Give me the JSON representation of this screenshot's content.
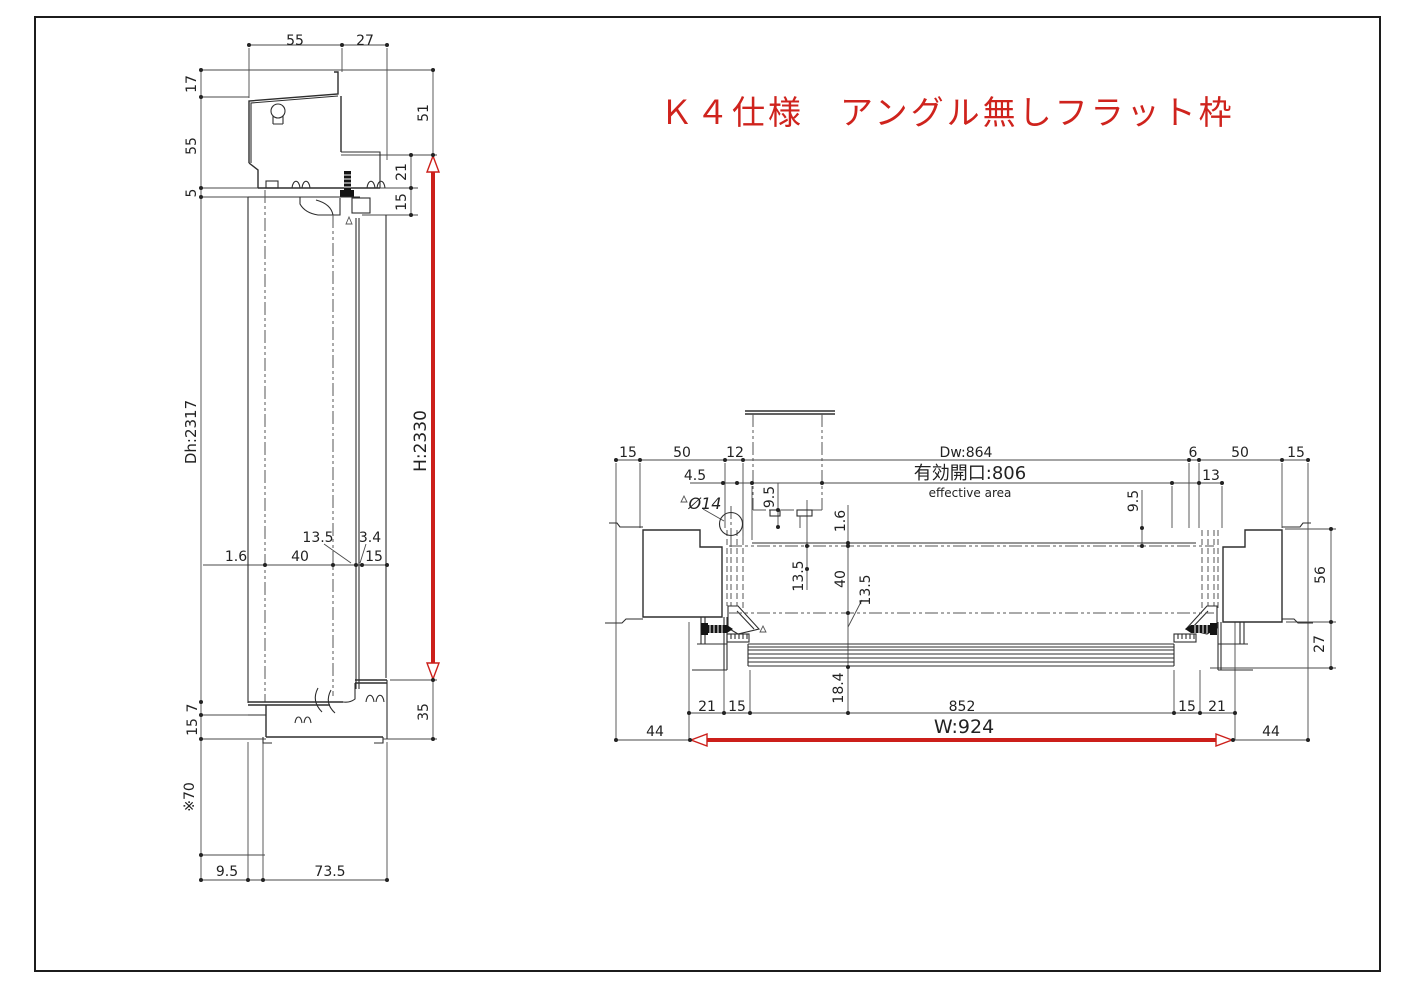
{
  "title": {
    "text": "Ｋ４仕様　アングル無しフラット枠",
    "color": "#cf231d"
  },
  "colors": {
    "line": "#2e2e2e",
    "red_dimension": "#cc1f1a",
    "background": "#ffffff"
  },
  "left_view": {
    "name": "vertical-section",
    "height_dimension": "H:2330",
    "door_height": "Dh:2317",
    "top_dims": [
      "55",
      "27"
    ],
    "left_dims": [
      "17",
      "55",
      "5",
      "Dh:2317",
      "7",
      "15",
      "※70"
    ],
    "right_dims": [
      "51",
      "21",
      "15",
      "H:2330",
      "35"
    ],
    "mid_dims": [
      "13.5",
      "3.4",
      "1.6",
      "40",
      "15"
    ],
    "bottom_dims": [
      "9.5",
      "73.5"
    ]
  },
  "right_view": {
    "name": "horizontal-section",
    "width_dimension": "W:924",
    "door_width": "Dw:864",
    "effective_opening_label": "有効開口:806",
    "effective_opening_sub": "effective area",
    "top_dims": [
      "15",
      "50",
      "12",
      "Dw:864",
      "6",
      "50",
      "15",
      "13",
      "4.5"
    ],
    "detail_dims": [
      "Ø14",
      "9.5",
      "9.5",
      "1.6",
      "13.5",
      "40",
      "13.5",
      "18.4"
    ],
    "bottom_dims": [
      "21",
      "15",
      "852",
      "15",
      "21",
      "44",
      "W:924",
      "44"
    ],
    "right_dims": [
      "56",
      "27"
    ]
  },
  "labels": [
    {
      "t": "55",
      "x": 295,
      "y": 40,
      "n": "dim-55-top"
    },
    {
      "t": "27",
      "x": 365,
      "y": 40,
      "n": "dim-27-top"
    },
    {
      "t": "17",
      "x": 191,
      "y": 84,
      "r": -90,
      "n": "dim-17"
    },
    {
      "t": "55",
      "x": 191,
      "y": 146,
      "r": -90,
      "n": "dim-55-left"
    },
    {
      "t": "5",
      "x": 191,
      "y": 193,
      "r": -90,
      "n": "dim-5"
    },
    {
      "t": "51",
      "x": 423,
      "y": 113,
      "r": -90,
      "n": "dim-51"
    },
    {
      "t": "21",
      "x": 401,
      "y": 172,
      "r": -90,
      "n": "dim-21"
    },
    {
      "t": "15",
      "x": 401,
      "y": 202,
      "r": -90,
      "n": "dim-15-head"
    },
    {
      "t": "Dh:2317",
      "x": 191,
      "y": 432,
      "r": -90,
      "s": 15,
      "n": "dim-door-height"
    },
    {
      "t": "H:2330",
      "x": 421,
      "y": 441,
      "r": -90,
      "s": 17,
      "n": "dim-frame-height"
    },
    {
      "t": "13.5",
      "x": 318,
      "y": 537,
      "n": "dim-13.5-left"
    },
    {
      "t": "3.4",
      "x": 370,
      "y": 537,
      "n": "dim-3.4"
    },
    {
      "t": "1.6",
      "x": 236,
      "y": 556,
      "n": "dim-1.6-left"
    },
    {
      "t": "40",
      "x": 300,
      "y": 556,
      "n": "dim-40-left"
    },
    {
      "t": "15",
      "x": 374,
      "y": 556,
      "n": "dim-15-mid"
    },
    {
      "t": "7",
      "x": 192,
      "y": 708,
      "r": -90,
      "n": "dim-7"
    },
    {
      "t": "15",
      "x": 192,
      "y": 727,
      "r": -90,
      "n": "dim-15-sill"
    },
    {
      "t": "35",
      "x": 423,
      "y": 712,
      "r": -90,
      "n": "dim-35"
    },
    {
      "t": "※70",
      "x": 189,
      "y": 797,
      "r": -90,
      "n": "dim-70"
    },
    {
      "t": "9.5",
      "x": 227,
      "y": 871,
      "n": "dim-9.5-bottom"
    },
    {
      "t": "73.5",
      "x": 330,
      "y": 871,
      "n": "dim-73.5"
    },
    {
      "t": "15",
      "x": 628,
      "y": 452,
      "n": "dim-15-tl"
    },
    {
      "t": "50",
      "x": 682,
      "y": 452,
      "n": "dim-50-left"
    },
    {
      "t": "12",
      "x": 735,
      "y": 452,
      "n": "dim-12"
    },
    {
      "t": "Dw:864",
      "x": 966,
      "y": 452,
      "n": "dim-door-width"
    },
    {
      "t": "有効開口:806",
      "x": 970,
      "y": 474,
      "s": 18,
      "n": "dim-effective-opening"
    },
    {
      "t": "effective area",
      "x": 970,
      "y": 492,
      "s": 12,
      "n": "label-effective-area"
    },
    {
      "t": "6",
      "x": 1193,
      "y": 452,
      "n": "dim-6"
    },
    {
      "t": "50",
      "x": 1240,
      "y": 452,
      "n": "dim-50-right"
    },
    {
      "t": "15",
      "x": 1296,
      "y": 452,
      "n": "dim-15-tr"
    },
    {
      "t": "13",
      "x": 1211,
      "y": 475,
      "n": "dim-13"
    },
    {
      "t": "4.5",
      "x": 695,
      "y": 475,
      "n": "dim-4.5"
    },
    {
      "t": "Ø14",
      "x": 705,
      "y": 504,
      "s": 16,
      "i": 1,
      "n": "dim-dia-14"
    },
    {
      "t": "9.5",
      "x": 769,
      "y": 497,
      "r": -90,
      "n": "dim-9.5-left"
    },
    {
      "t": "9.5",
      "x": 1133,
      "y": 501,
      "r": -90,
      "n": "dim-9.5-right"
    },
    {
      "t": "1.6",
      "x": 840,
      "y": 521,
      "r": -90,
      "n": "dim-1.6-right"
    },
    {
      "t": "13.5",
      "x": 798,
      "y": 576,
      "r": -90,
      "n": "dim-13.5-a"
    },
    {
      "t": "40",
      "x": 840,
      "y": 579,
      "r": -90,
      "n": "dim-40-right"
    },
    {
      "t": "13.5",
      "x": 865,
      "y": 590,
      "r": -90,
      "n": "dim-13.5-b"
    },
    {
      "t": "18.4",
      "x": 838,
      "y": 688,
      "r": -90,
      "n": "dim-18.4"
    },
    {
      "t": "21",
      "x": 707,
      "y": 706,
      "n": "dim-21-bl"
    },
    {
      "t": "15",
      "x": 737,
      "y": 706,
      "n": "dim-15-bl"
    },
    {
      "t": "852",
      "x": 962,
      "y": 706,
      "n": "dim-852"
    },
    {
      "t": "15",
      "x": 1187,
      "y": 706,
      "n": "dim-15-br"
    },
    {
      "t": "21",
      "x": 1217,
      "y": 706,
      "n": "dim-21-br"
    },
    {
      "t": "44",
      "x": 655,
      "y": 731,
      "n": "dim-44-left"
    },
    {
      "t": "W:924",
      "x": 964,
      "y": 728,
      "s": 19,
      "n": "dim-frame-width"
    },
    {
      "t": "44",
      "x": 1271,
      "y": 731,
      "n": "dim-44-right"
    },
    {
      "t": "56",
      "x": 1320,
      "y": 575,
      "r": -90,
      "n": "dim-56"
    },
    {
      "t": "27",
      "x": 1319,
      "y": 644,
      "r": -90,
      "n": "dim-27-right"
    }
  ]
}
